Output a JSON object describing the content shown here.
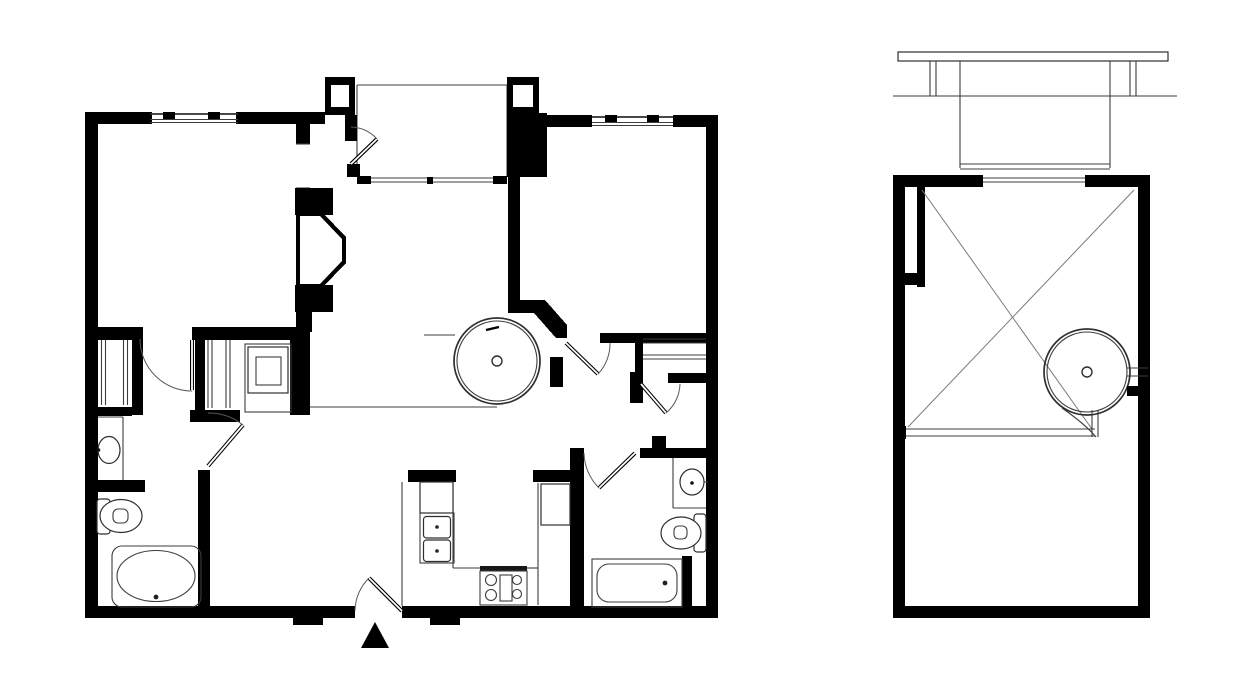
{
  "plan_title": "Two-panel apartment floor plan",
  "rooms": {
    "master_bedroom": {
      "name_line1": "MASTER",
      "name_line2": "BEDROOM",
      "dims": "11'-6\" X 12'-0\""
    },
    "living": {
      "name": "LIVING",
      "dims": "12'-0\" X 13'-2\""
    },
    "bedroom": {
      "name": "BEDROOM",
      "dims": "11'-1\" X 12'-0\""
    },
    "dining": {
      "name": "DINNING",
      "dims": "8'-0\" X 11'-6\""
    },
    "loft": {
      "name": "LOFT",
      "dims": "9'-9\" X 13'-6\""
    }
  },
  "colors": {
    "wall": "#000000",
    "thin_line": "#3c3c3c",
    "background": "#ffffff"
  }
}
